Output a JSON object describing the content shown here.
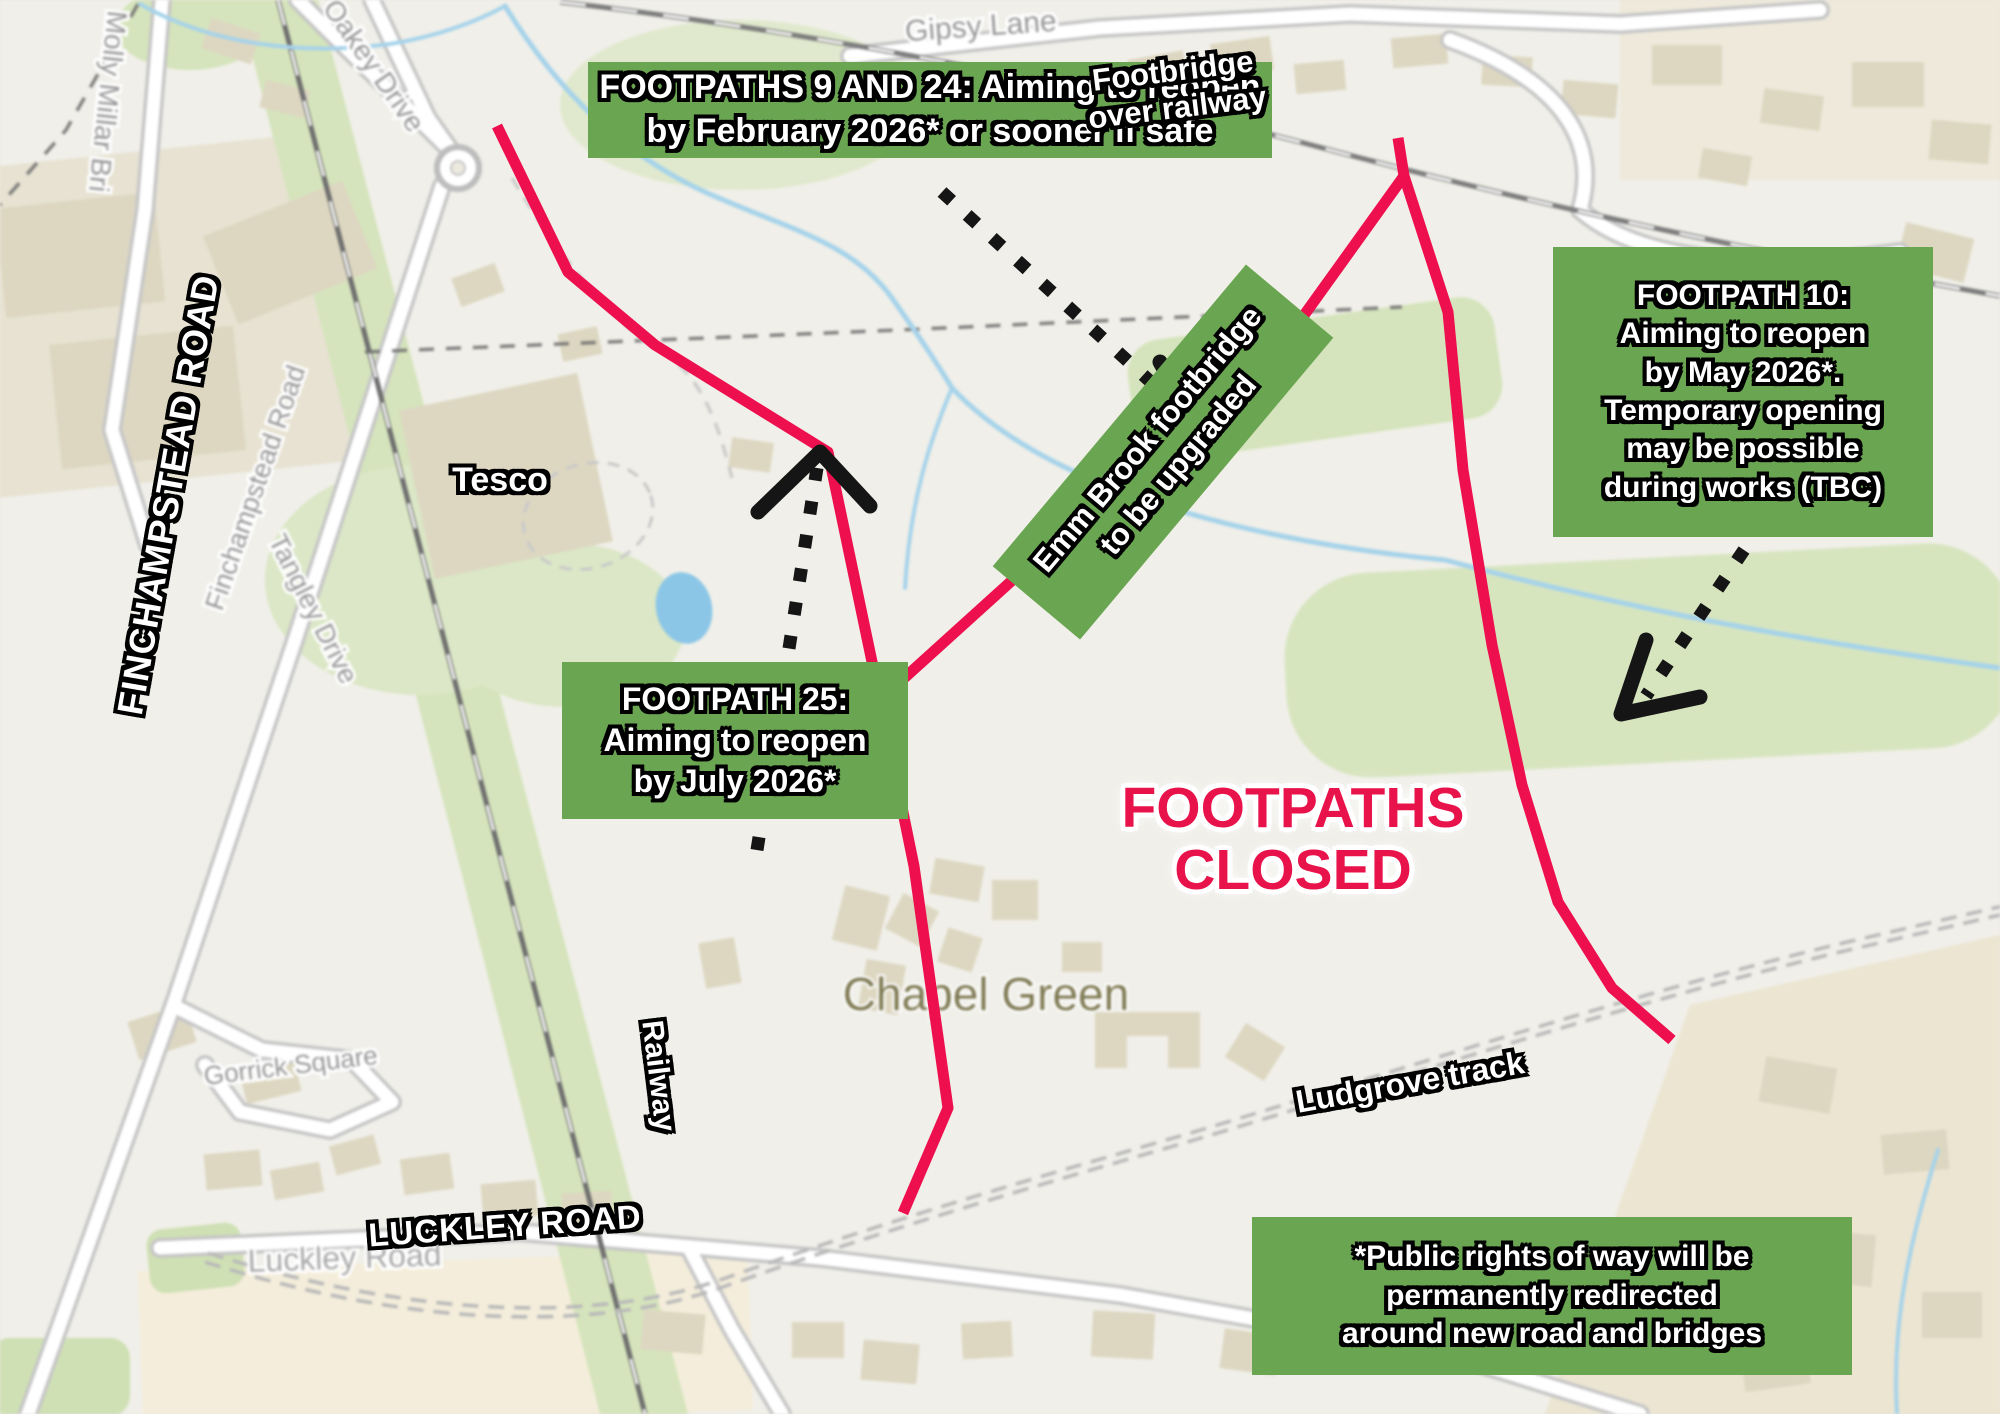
{
  "colors": {
    "box_green": "#6aa551",
    "route_pink": "#ee0f4e",
    "closed_text": "#e8134a",
    "arrow_black": "#151515"
  },
  "boxes": {
    "footpaths_9_24": {
      "lines": [
        "FOOTPATHS 9 AND 24: Aiming to reopen",
        "by February 2026* or sooner if safe"
      ]
    },
    "footpath_10": {
      "lines": [
        "FOOTPATH 10:",
        "Aiming to reopen",
        "by May 2026*.",
        "Temporary opening",
        "may be possible",
        "during works (TBC)"
      ]
    },
    "footpath_25": {
      "lines": [
        "FOOTPATH 25:",
        "Aiming to reopen",
        "by July 2026*"
      ]
    },
    "emm_brook": {
      "lines": [
        "Emm Brook footbridge",
        "to be upgraded"
      ]
    },
    "footnote": {
      "lines": [
        "*Public rights of way will be",
        "permanently redirected",
        "around new road and bridges"
      ]
    }
  },
  "overlay_labels": {
    "footpaths_closed": {
      "lines": [
        "FOOTPATHS",
        "CLOSED"
      ]
    },
    "tesco": "Tesco",
    "footbridge": {
      "lines": [
        "Footbridge",
        "over railway"
      ]
    },
    "finchampstead_road": "FINCHAMPSTEAD ROAD",
    "railway": "Railway",
    "luckley_road": "LUCKLEY ROAD",
    "ludgrove_track": "Ludgrove track"
  },
  "map_labels": {
    "gipsy_lane": "Gipsy Lane",
    "molly_millar": "Molly Millar Bri",
    "oakey_drive": "Oakey Drive",
    "finchampstead_road": "Finchampstead Road",
    "tangley_drive": "Tangley Drive",
    "gorrick_square": "Gorrick Square",
    "luckley_road": "Luckley Road",
    "chapel_green": "Chapel Green"
  }
}
